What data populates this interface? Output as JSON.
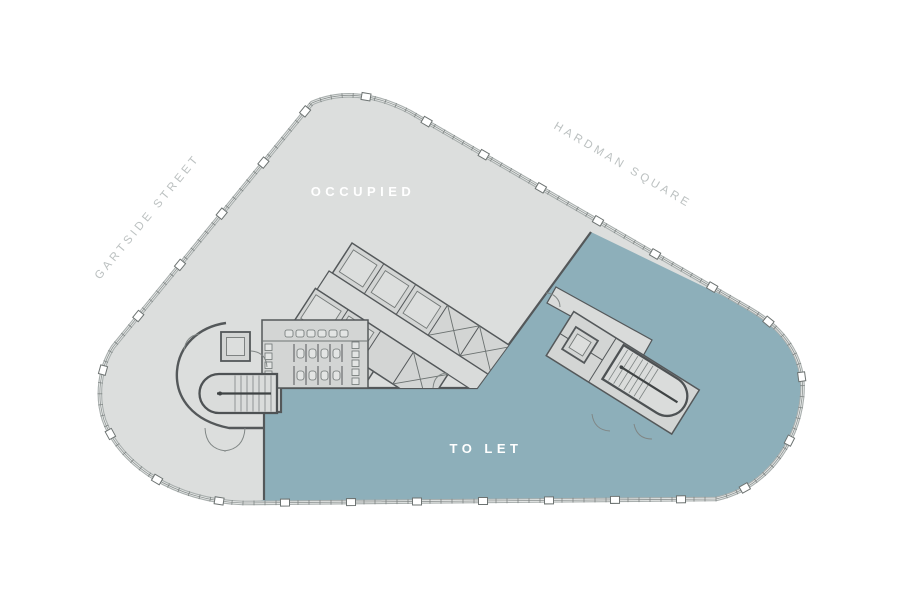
{
  "canvas": {
    "background": "#ffffff"
  },
  "plan": {
    "streets": {
      "gartside": {
        "label": "GARTSIDE STREET",
        "color": "#bcc1c1"
      },
      "hardman": {
        "label": "HARDMAN SQUARE",
        "color": "#bcc1c1"
      }
    },
    "zones": {
      "occupied": {
        "label": "OCCUPIED",
        "fill": "#dcdedd",
        "label_color": "#ffffff"
      },
      "to_let": {
        "label": "TO LET",
        "fill": "#8dafba",
        "label_color": "#ffffff"
      }
    }
  }
}
